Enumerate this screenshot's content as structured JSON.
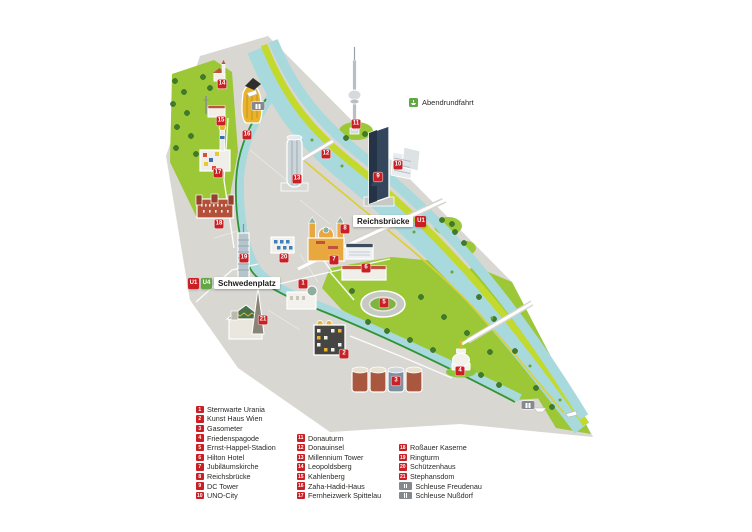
{
  "route": {
    "label": "Abendrundfahrt",
    "badge_color": "#62a744",
    "x": 409,
    "y": 103
  },
  "stations": [
    {
      "id": "reichsbruecke",
      "label": "Reichsbrücke",
      "lines": [
        {
          "id": "U1",
          "color": "#c92026"
        }
      ],
      "lines_after": true,
      "x": 353,
      "y": 221
    },
    {
      "id": "schwedenplatz",
      "label": "Schwedenplatz",
      "lines": [
        {
          "id": "U1",
          "color": "#c92026"
        },
        {
          "id": "U4",
          "color": "#62a744"
        }
      ],
      "lines_after": false,
      "x": 188,
      "y": 283
    }
  ],
  "markers": [
    {
      "num": "1",
      "name": "Sternwarte Urania",
      "x": 303,
      "y": 284
    },
    {
      "num": "2",
      "name": "Kunst Haus Wien",
      "x": 344,
      "y": 354
    },
    {
      "num": "3",
      "name": "Gasometer",
      "x": 396,
      "y": 381
    },
    {
      "num": "4",
      "name": "Friedenspagode",
      "x": 460,
      "y": 371
    },
    {
      "num": "5",
      "name": "Ernst-Happel-Stadion",
      "x": 384,
      "y": 303
    },
    {
      "num": "6",
      "name": "Hilton Hotel",
      "x": 366,
      "y": 268
    },
    {
      "num": "7",
      "name": "Jubiläumskirche",
      "x": 334,
      "y": 260
    },
    {
      "num": "8",
      "name": "Reichsbrücke",
      "x": 345,
      "y": 229
    },
    {
      "num": "9",
      "name": "DC Tower",
      "x": 378,
      "y": 177
    },
    {
      "num": "10",
      "name": "UNO-City",
      "x": 398,
      "y": 165
    },
    {
      "num": "11",
      "name": "Donauturm",
      "x": 356,
      "y": 124
    },
    {
      "num": "12",
      "name": "Donauinsel",
      "x": 326,
      "y": 154
    },
    {
      "num": "13",
      "name": "Millennium Tower",
      "x": 297,
      "y": 179
    },
    {
      "num": "14",
      "name": "Leopoldsberg",
      "x": 222,
      "y": 84
    },
    {
      "num": "15",
      "name": "Kahlenberg",
      "x": 221,
      "y": 121
    },
    {
      "num": "16",
      "name": "Zaha-Hadid-Haus",
      "x": 247,
      "y": 135
    },
    {
      "num": "17",
      "name": "Fernheizwerk Spittelau",
      "x": 218,
      "y": 173
    },
    {
      "num": "18",
      "name": "Roßauer Kaserne",
      "x": 219,
      "y": 224
    },
    {
      "num": "19",
      "name": "Ringturm",
      "x": 244,
      "y": 258
    },
    {
      "num": "20",
      "name": "Schützenhaus",
      "x": 284,
      "y": 258
    },
    {
      "num": "21",
      "name": "Stephansdom",
      "x": 263,
      "y": 320
    }
  ],
  "locks": [
    {
      "name": "Schleuse Nußdorf",
      "x": 258,
      "y": 106
    },
    {
      "name": "Schleuse Freudenau",
      "x": 528,
      "y": 405
    }
  ],
  "legend": {
    "columns": [
      {
        "x": 196,
        "y": 404.5,
        "items": [
          {
            "num": "1",
            "label": "Sternwarte Urania"
          },
          {
            "num": "2",
            "label": "Kunst Haus Wien"
          },
          {
            "num": "3",
            "label": "Gasometer"
          },
          {
            "num": "4",
            "label": "Friedenspagode"
          },
          {
            "num": "5",
            "label": "Ernst-Happel-Stadion"
          },
          {
            "num": "6",
            "label": "Hilton Hotel"
          },
          {
            "num": "7",
            "label": "Jubiläumskirche"
          },
          {
            "num": "8",
            "label": "Reichsbrücke"
          },
          {
            "num": "9",
            "label": "DC Tower"
          },
          {
            "num": "10",
            "label": "UNO-City"
          }
        ]
      },
      {
        "x": 297,
        "y": 433.3,
        "items": [
          {
            "num": "11",
            "label": "Donauturm"
          },
          {
            "num": "12",
            "label": "Donauinsel"
          },
          {
            "num": "13",
            "label": "Millennium Tower"
          },
          {
            "num": "14",
            "label": "Leopoldsberg"
          },
          {
            "num": "15",
            "label": "Kahlenberg"
          },
          {
            "num": "16",
            "label": "Zaha-Hadid-Haus"
          },
          {
            "num": "17",
            "label": "Fernheizwerk Spittelau"
          }
        ]
      },
      {
        "x": 399,
        "y": 442.9,
        "items": [
          {
            "num": "18",
            "label": "Roßauer Kaserne"
          },
          {
            "num": "19",
            "label": "Ringturm"
          },
          {
            "num": "20",
            "label": "Schützenhaus"
          },
          {
            "num": "21",
            "label": "Stephansdom"
          },
          {
            "badge": "lock",
            "label": "Schleuse Freudenau"
          },
          {
            "badge": "lock",
            "label": "Schleuse Nußdorf"
          }
        ]
      }
    ]
  },
  "colors": {
    "marker_red": "#c92026",
    "u1_red": "#c92026",
    "u4_green": "#62a744",
    "route_green": "#2e9435",
    "lock_gray": "#85898d",
    "map_gray": "#d8d7d2",
    "park_green": "#9cc838",
    "tree_green": "#3e7b2b",
    "island_green": "#c4d92e",
    "water_blue": "#a8d9dd",
    "text_dark": "#2a2927"
  }
}
